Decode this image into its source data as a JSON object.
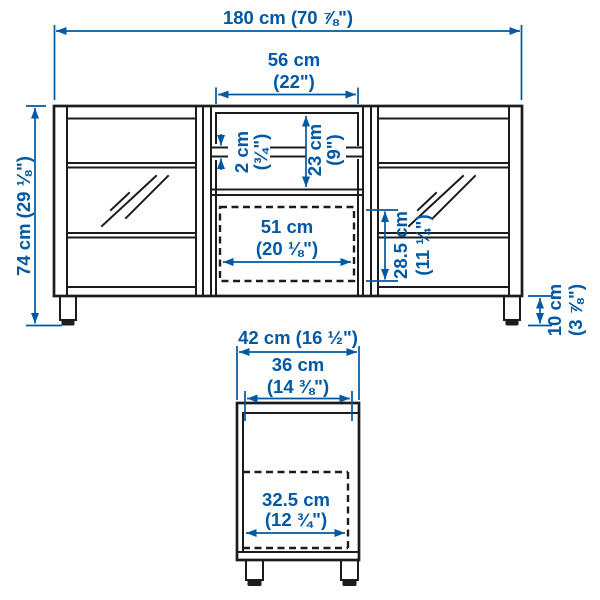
{
  "colors": {
    "accent": "#0058a3",
    "line": "#1c1c1e",
    "background": "#ffffff"
  },
  "dims": {
    "total_width": {
      "text": "180 cm (70 ⅞\")"
    },
    "middle_width": {
      "line1": "56 cm",
      "line2": "(22\")"
    },
    "shelf_thickness": {
      "line1": "2 cm",
      "line2": "(¾\")"
    },
    "open_compartment_height": {
      "line1": "23 cm",
      "line2": "(9\")"
    },
    "drawer_opening_width": {
      "line1": "51 cm",
      "line2": "(20 ⅛\")"
    },
    "drawer_opening_height": {
      "line1": "28.5 cm",
      "line2": "(11 ¼\")"
    },
    "total_height": {
      "text": "74 cm (29 ⅛\")"
    },
    "leg_height": {
      "line1": "10 cm",
      "line2": "(3 ⅞\")"
    },
    "total_depth": {
      "text": "42 cm (16 ½\")"
    },
    "top_depth": {
      "line1": "36 cm",
      "line2": "(14 ⅜\")"
    },
    "drawer_depth": {
      "line1": "32.5 cm",
      "line2": "(12 ¾\")"
    }
  }
}
